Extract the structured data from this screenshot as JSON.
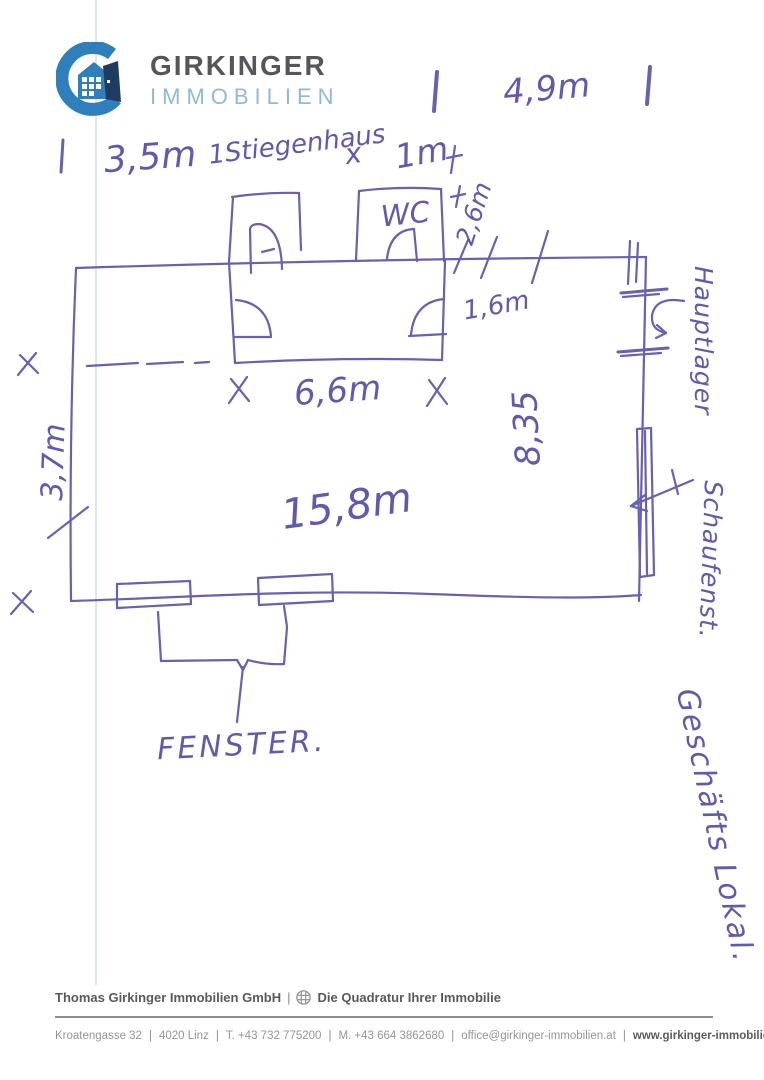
{
  "page": {
    "background": "#ffffff",
    "ink_color": "#584fa8"
  },
  "logo": {
    "brand_primary": "GIRKINGER",
    "brand_secondary": "IMMOBILIEN",
    "icon_ring_color": "#2f7fbc",
    "icon_door_color": "#1e3c5f",
    "primary_text_color": "#55565a",
    "secondary_text_color": "#8fb9da"
  },
  "sketch": {
    "dim_top": "4,9m",
    "dim_row2_left": "3,5m",
    "stairwell_label": "1Stiegenhaus",
    "multiply_mark": "x",
    "dim_row2_right": "1m",
    "wc_label": "WC",
    "dim_wc_depth": "2,6m",
    "dim_door_offset": "1,6m",
    "dim_block_width": "6,6m",
    "dim_room_depth": "8,35",
    "dim_room_width": "15,8m",
    "dim_left_height": "3,7m",
    "window_label": "FENSTER.",
    "right_label_top": "Hauptlager",
    "right_label_mid": "Schaufenst.",
    "right_label_bottom": "Geschäfts Lokal."
  },
  "footer": {
    "company": "Thomas Girkinger Immobilien GmbH",
    "separator": "|",
    "tagline": "Die Quadratur Ihrer Immobilie",
    "contact": {
      "address": "Kroatengasse 32",
      "city": "4020 Linz",
      "phone": "T. +43 732 775200",
      "mobile": "M. +43 664 3862680",
      "email": "office@girkinger-immobilien.at",
      "web": "www.girkinger-immobilien.at"
    }
  }
}
